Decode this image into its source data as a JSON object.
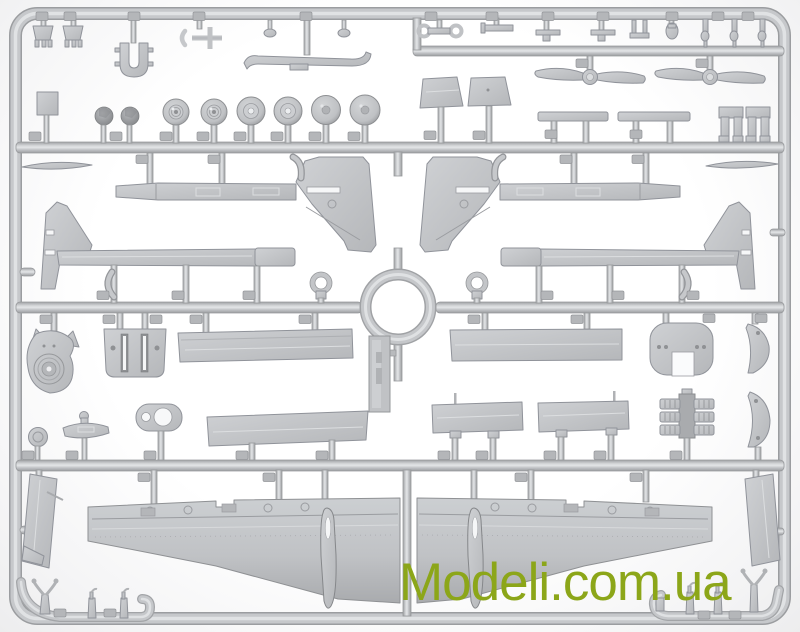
{
  "watermark": {
    "text": "Modeli.com.ua",
    "color": "#8ca619"
  },
  "photo": {
    "background_color": "#ffffff",
    "plastic_color": "#c3c5c8",
    "plastic_shadow_color": "#97999c",
    "plastic_highlight_color": "#e4e6e8",
    "subject": "Gray plastic injection-molded sprue of aircraft model kit parts"
  },
  "sprue": {
    "part_groups": [
      "antenna-mounts",
      "u-clamp",
      "pitot-fork",
      "exhaust-skid",
      "small-fittings",
      "two-blade-propellers",
      "canopy-panels",
      "wing-strips",
      "landing-gear-forks",
      "main-wheels",
      "faceted-domes",
      "mounting-plate",
      "tail-booms-with-fins",
      "elevator-blades",
      "towing-rings",
      "engine-cowling-face",
      "slotted-bulkhead",
      "fuselage-panels",
      "mirror-disc",
      "float-fairing",
      "spectacle-plate",
      "rounded-bulkhead",
      "root-fairings",
      "flap-panels",
      "radial-engine-block",
      "outer-wing-panels",
      "teardrop-pods",
      "door-panels",
      "horned-masts",
      "bent-tip-posts",
      "sprue-id-tag",
      "part-number-tabs"
    ]
  }
}
